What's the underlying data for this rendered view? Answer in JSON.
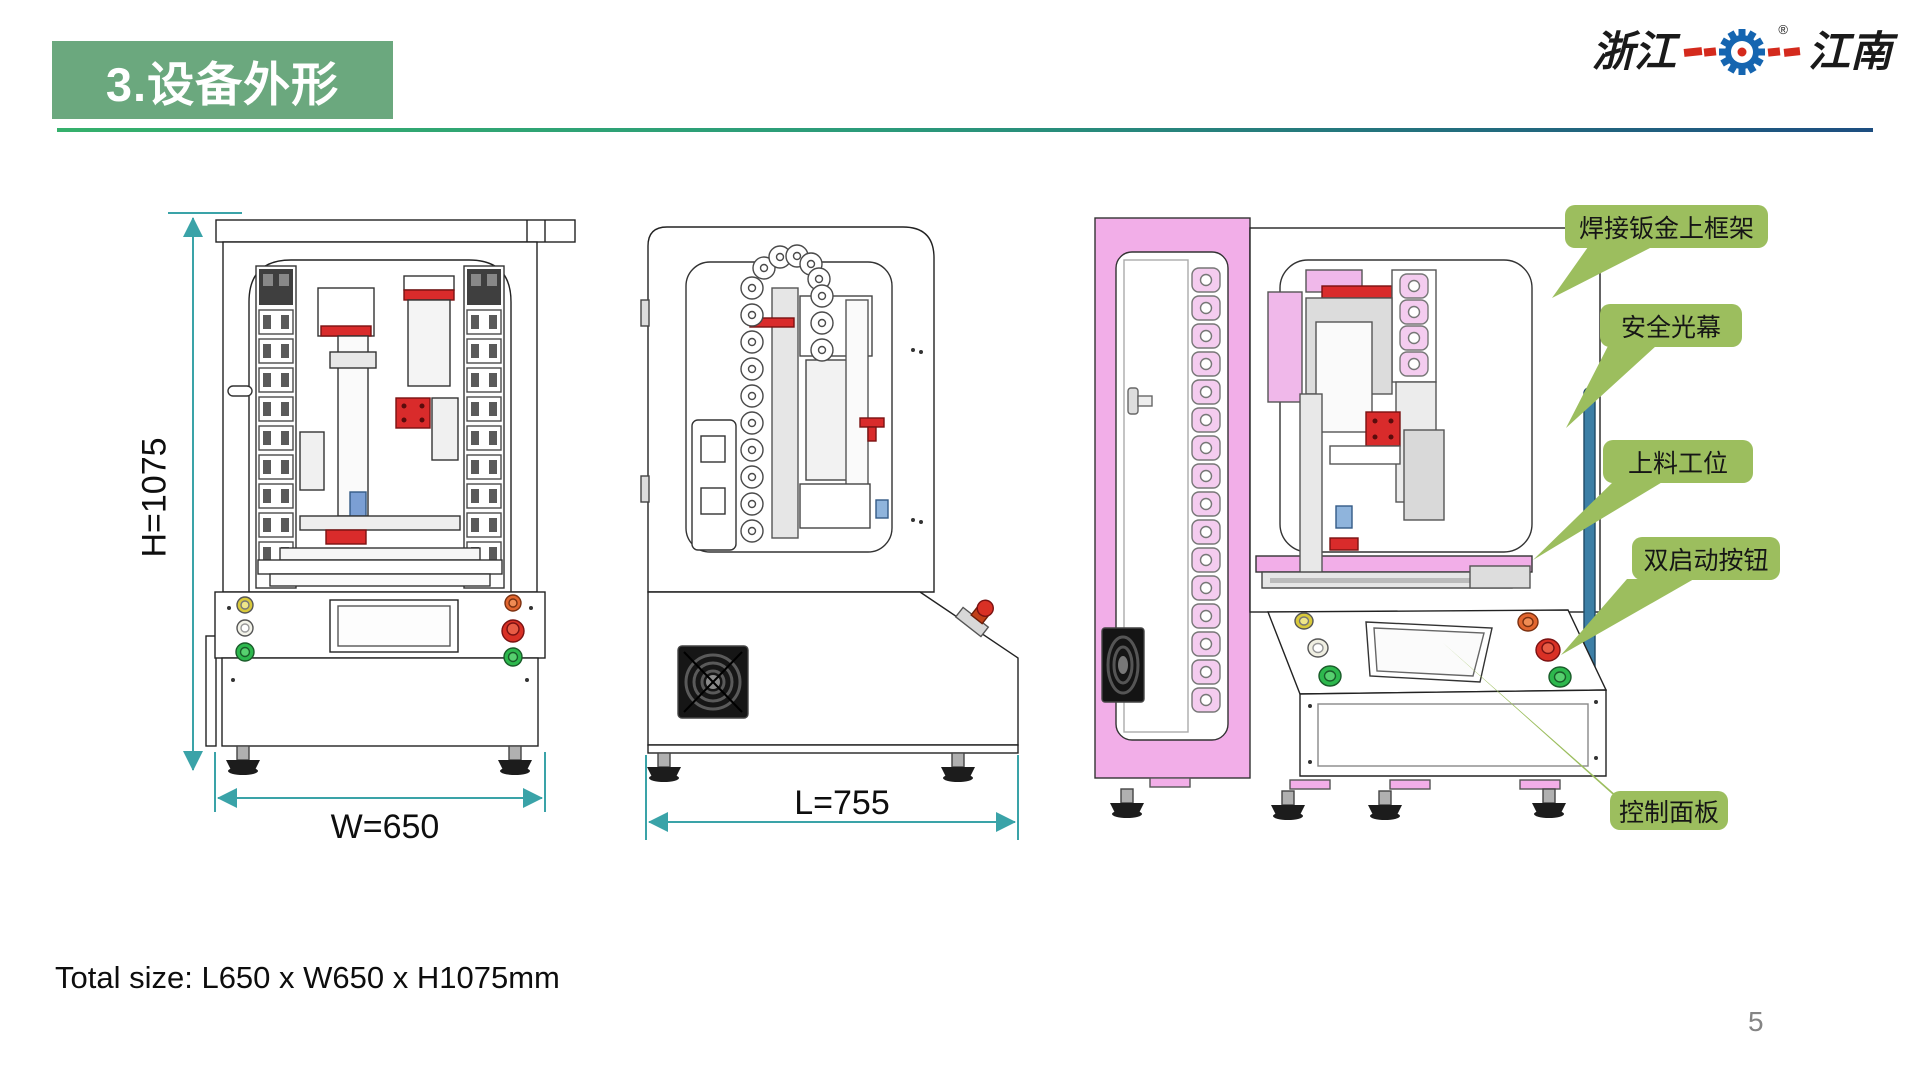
{
  "header": {
    "title": "3.设备外形",
    "logo": {
      "left_text": "浙江",
      "right_text": "江南",
      "registered_mark": "®"
    }
  },
  "dimensions": {
    "height_label": "H=1075",
    "width_label": "W=650",
    "length_label": "L=755"
  },
  "views": {
    "front": "front-view",
    "side": "side-view",
    "iso": "iso-3d-view"
  },
  "callouts": [
    {
      "id": "welded-sheet-metal-upper-frame",
      "label": "焊接钣金上框架"
    },
    {
      "id": "safety-light-curtain",
      "label": "安全光幕"
    },
    {
      "id": "loading-station",
      "label": "上料工位"
    },
    {
      "id": "dual-start-buttons",
      "label": "双启动按钮"
    },
    {
      "id": "control-panel",
      "label": "控制面板"
    }
  ],
  "footer": {
    "total_size_text": "Total size: L650 x W650 x H1075mm",
    "page_number": "5"
  },
  "colors": {
    "title_green": "#6ba87e",
    "underline_green": "#35b06c",
    "underline_blue": "#1d4e80",
    "callout_green": "#9cbe5e",
    "dimension_teal": "#3aa3a8",
    "machine_pink": "#f2aee8",
    "light_curtain_blue": "#3c7fa6",
    "accent_red": "#d92b2b",
    "logo_blue": "#1565b0",
    "logo_red": "#d42a1d"
  }
}
